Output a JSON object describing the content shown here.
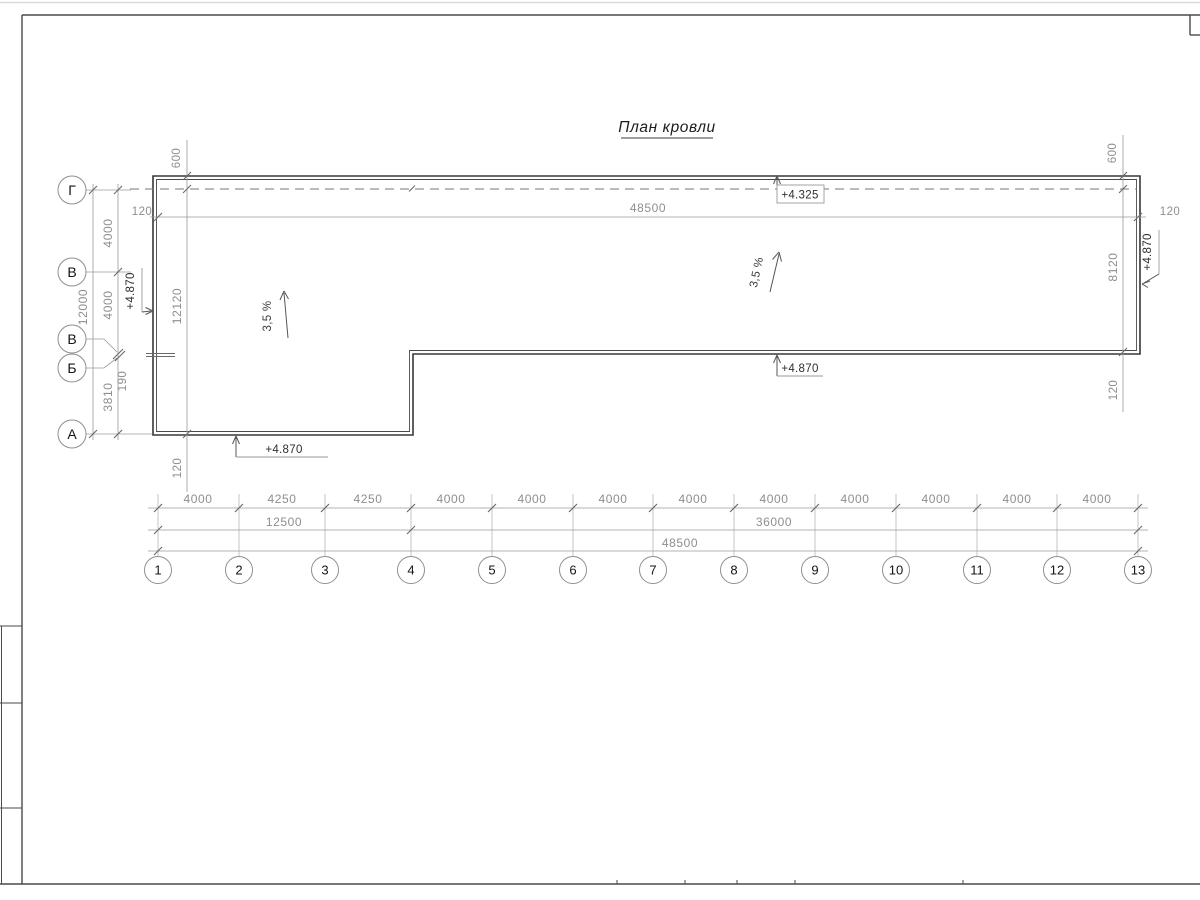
{
  "sheet": {
    "title": "План кровли"
  },
  "axes": {
    "bottom": [
      "1",
      "2",
      "3",
      "4",
      "5",
      "6",
      "7",
      "8",
      "9",
      "10",
      "11",
      "12",
      "13"
    ],
    "left": [
      "Г",
      "В",
      "В",
      "Б",
      "А"
    ]
  },
  "dimensions": {
    "bottom_chain": [
      "4000",
      "4250",
      "4250",
      "4000",
      "4000",
      "4000",
      "4000",
      "4000",
      "4000",
      "4000",
      "4000",
      "4000"
    ],
    "bottom_subtotals": [
      "12500",
      "36000"
    ],
    "bottom_total": "48500",
    "top_length": "48500",
    "top_offset_left": "120",
    "top_offset_right": "120",
    "left_segments": [
      "4000",
      "4000",
      "190",
      "3810"
    ],
    "left_total": "12000",
    "left_edge": {
      "top": "600",
      "middle": "12120",
      "bottom": "120"
    },
    "right_edge": {
      "top": "600",
      "middle": "8120",
      "bottom": "120"
    }
  },
  "elevations": {
    "ridge": "+4.325",
    "step": "+4.870",
    "bottom": "+4.870",
    "left": "+4.870",
    "right": "+4.870"
  },
  "slopes": {
    "left": "3,5 %",
    "right": "3,5 %"
  },
  "colors": {
    "outline": "#383838",
    "thin": "#9a9a9a",
    "frame": "#4a4a4a",
    "dim_text": "#8e8e8e",
    "dark_text": "#1c1c1c"
  }
}
